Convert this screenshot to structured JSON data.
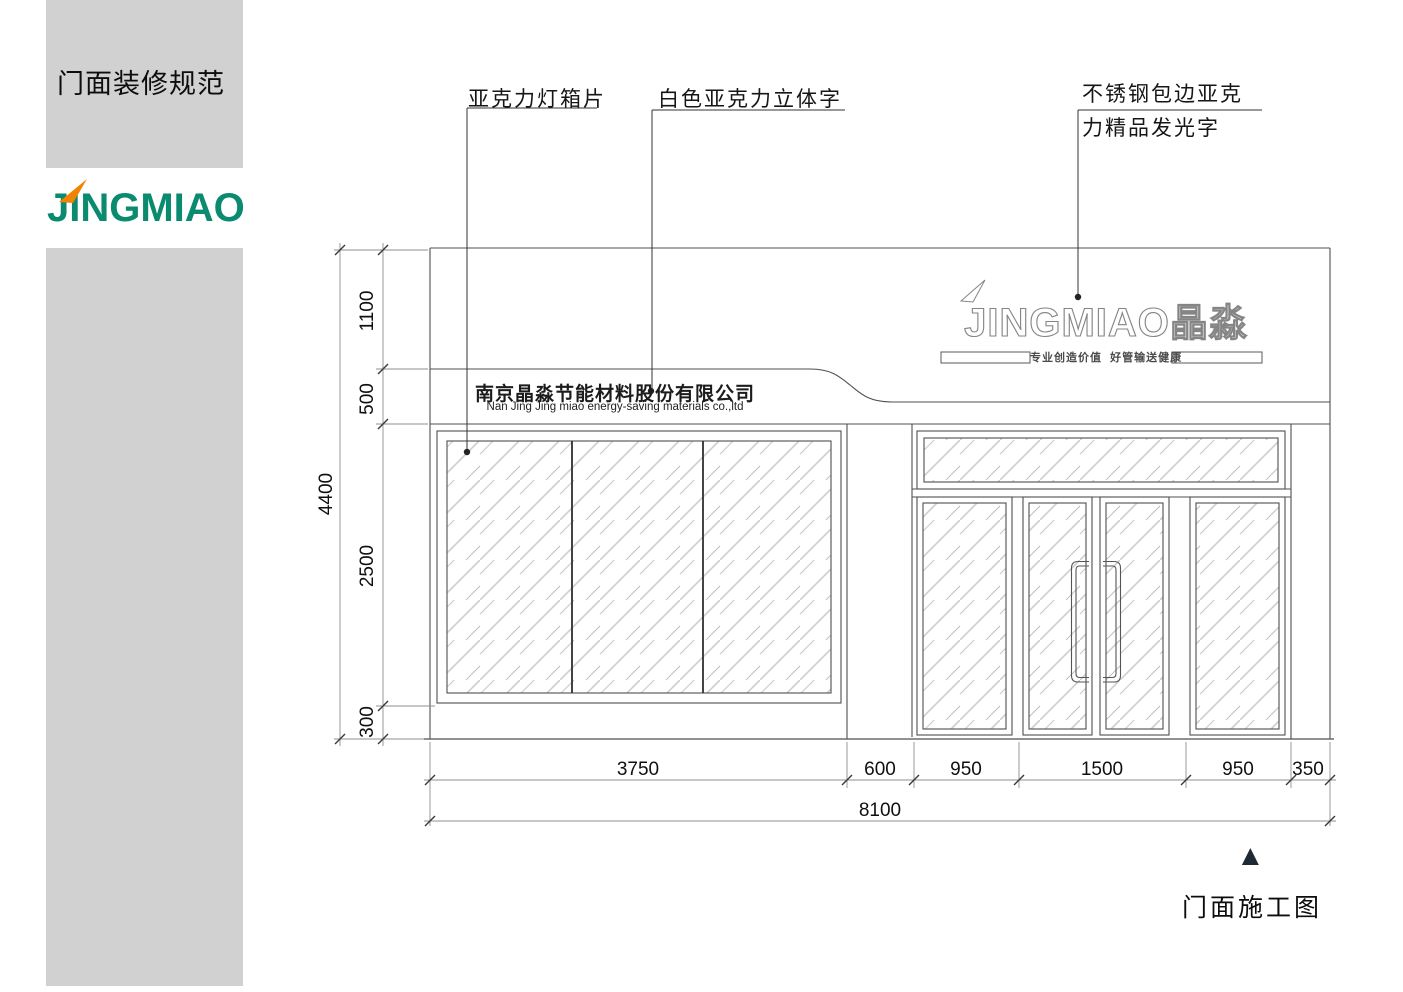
{
  "sidebar": {
    "title": "门面装修规范",
    "logo_text": "JINGMIAO",
    "colors": {
      "panel": "#d1d1d1",
      "logo_green": "#0a8a6f",
      "flame_orange": "#f08300"
    }
  },
  "callouts": {
    "lightbox": "亚克力灯箱片",
    "acrylic_letters": "白色亚克力立体字",
    "steel_sign_line1": "不锈钢包边亚克",
    "steel_sign_line2": "力精品发光字"
  },
  "storefront": {
    "sign_latin": "JINGMIAO",
    "sign_cn": "晶淼",
    "tagline": "专业创造价值  好管输送健康",
    "company_cn": "南京晶淼节能材料股份有限公司",
    "company_en": "Nan Jing Jing miao energy-saving materials co.,ltd"
  },
  "dimensions": {
    "vertical_total": "4400",
    "vertical_segments": [
      "1100",
      "500",
      "2500",
      "300"
    ],
    "horizontal_segments": [
      "3750",
      "600",
      "950",
      "1500",
      "950",
      "350"
    ],
    "horizontal_total": "8100"
  },
  "caption": {
    "marker": "▲",
    "text": "门面施工图"
  }
}
